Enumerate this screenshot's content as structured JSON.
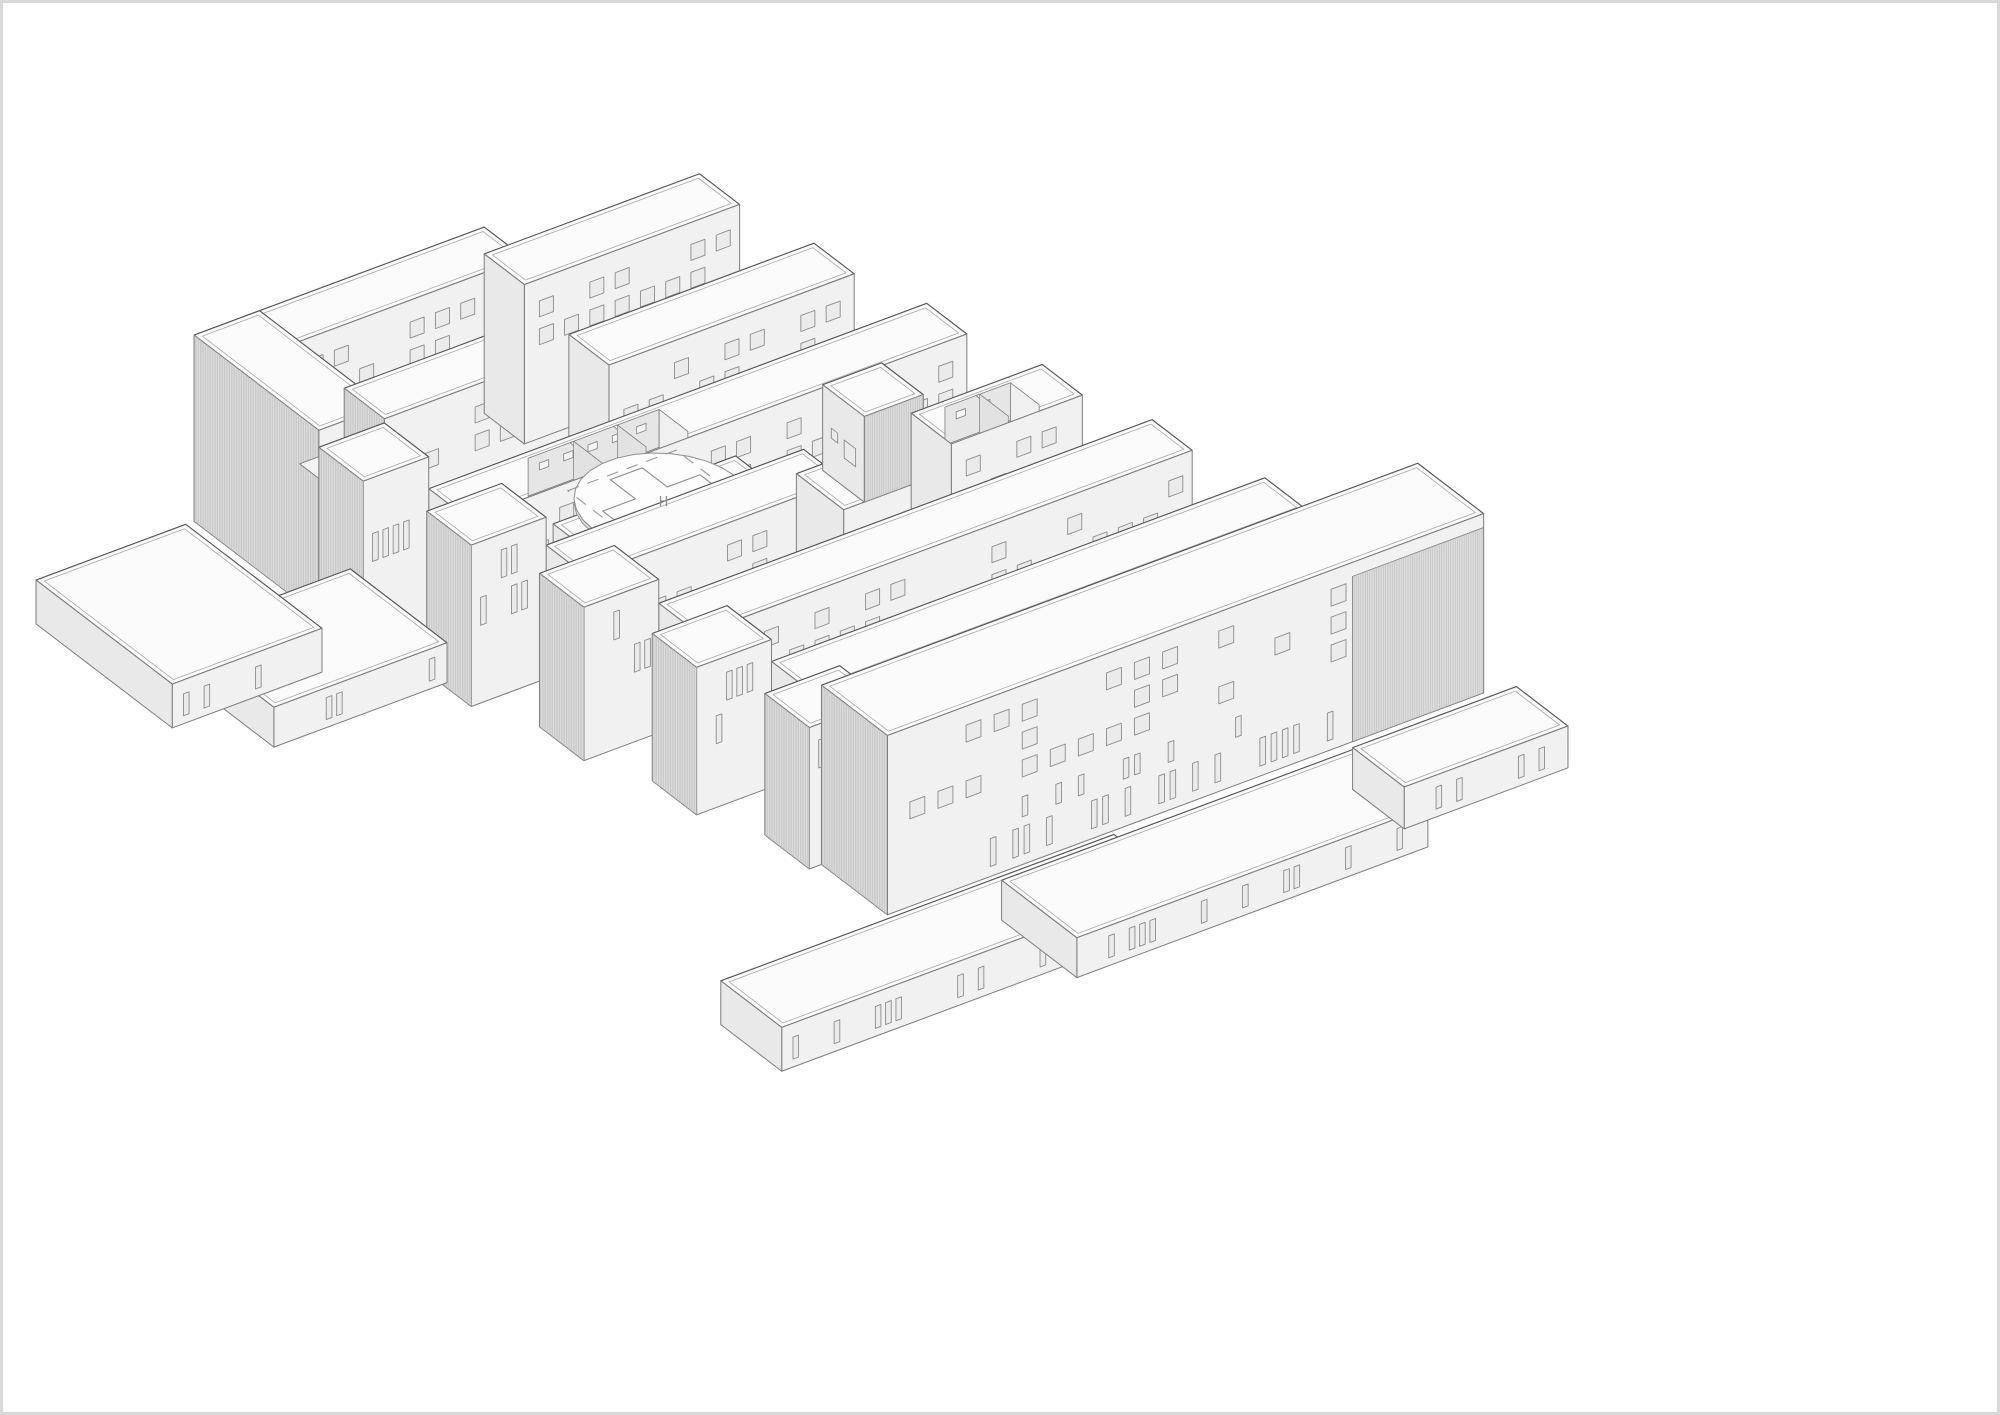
{
  "title": "Axonometric massing drawing of a hospital complex",
  "canvas": {
    "width": 2000,
    "height": 1415,
    "background": "#ffffff",
    "frame_color": "#d9d9d9"
  },
  "palette": {
    "roof": "#fbfbfb",
    "facade": "#f1f1f1",
    "end_face": "#e9e9e9",
    "hatch_bg": "#dcdcdc",
    "hatch_line": "#c3c3c3",
    "courtyard_wall": "#e6e6e6",
    "floor": "#f3f3f3",
    "hole_floor": "#ededed",
    "line": "#7d7d7d",
    "line_dark": "#565656",
    "inset_line": "#a8a8a8",
    "window_line": "#8c8c8c",
    "window_fill": "#ebebeb",
    "pad_top": "#fdfdfd",
    "pad_side": "#dadada",
    "pad_line": "#8f8f8f",
    "dash_line": "#9a9a9a"
  },
  "projection": {
    "ox": 200,
    "oy": 565,
    "u": [
      0.94,
      -0.35
    ],
    "v": [
      0.72,
      0.55
    ]
  },
  "helipad": {
    "a": 245,
    "b": 322,
    "z": 150,
    "radius": 76,
    "square_half": 58,
    "cross_arm": 52,
    "cross_width": 17,
    "dash_pattern": "12 9",
    "label": "H"
  },
  "masses": [
    {
      "name": "block-a-back-wing",
      "a0": 0,
      "a1": 300,
      "b0": 0,
      "b1": 56,
      "z0": 48,
      "z1": 235,
      "win": "sq",
      "seed": 11,
      "roofInset": true
    },
    {
      "name": "block-a-left-block",
      "a0": -10,
      "a1": 60,
      "b0": 0,
      "b1": 174,
      "z0": 48,
      "z1": 235,
      "win": "slit",
      "seed": 12,
      "roofInset": true,
      "hatchLeft": true
    },
    {
      "name": "block-a-courtyard-floor",
      "type": "slab",
      "a0": 60,
      "a1": 300,
      "b0": 56,
      "b1": 118,
      "zTop": 112
    },
    {
      "name": "block-a-front-wing",
      "a0": 60,
      "a1": 300,
      "b0": 118,
      "b1": 174,
      "z0": 48,
      "z1": 222,
      "win": "sq",
      "seed": 13,
      "roofInset": true,
      "hatchLeft": true
    },
    {
      "name": "back-long-bar",
      "a0": 300,
      "a1": 530,
      "b0": 0,
      "b1": 56,
      "z0": 48,
      "z1": 208,
      "win": "sq",
      "seed": 14,
      "roofInset": true
    },
    {
      "name": "row1-bar",
      "a0": 300,
      "a1": 562,
      "b0": 118,
      "b1": 174,
      "z0": 48,
      "z1": 192,
      "win": "sq",
      "seed": 15,
      "roofInset": true
    },
    {
      "name": "row2-bar",
      "a0": 60,
      "a1": 592,
      "b0": 236,
      "b1": 292,
      "z0": 48,
      "z1": 186,
      "win": "sq",
      "seed": 16,
      "roofInset": true,
      "hole": {
        "a0": 160,
        "a1": 300,
        "b0": 244,
        "b1": 284,
        "dividers": 2
      }
    },
    {
      "name": "helipad-pedestal",
      "a0": 150,
      "a1": 345,
      "b0": 292,
      "b1": 354,
      "z0": 48,
      "z1": 150,
      "roofInset": true,
      "helipad": true
    },
    {
      "name": "row3-bar-left",
      "a0": 95,
      "a1": 370,
      "b0": 354,
      "b1": 410,
      "z0": 48,
      "z1": 182,
      "win": "sq",
      "seed": 17,
      "roofInset": true
    },
    {
      "name": "plant-room-pedestal",
      "a0": 370,
      "a1": 485,
      "b0": 344,
      "b1": 410,
      "z0": 48,
      "z1": 152,
      "roofInset": true
    },
    {
      "name": "plant-room-cube",
      "a0": 392,
      "a1": 455,
      "b0": 352,
      "b1": 410,
      "z0": 152,
      "z1": 238,
      "roofInset": true,
      "hatchFacade": "full",
      "cubeWin": true
    },
    {
      "name": "row3-bar-right",
      "a0": 485,
      "a1": 625,
      "b0": 354,
      "b1": 410,
      "z0": 48,
      "z1": 178,
      "win": "sq",
      "seed": 18,
      "roofInset": true,
      "hole": {
        "a0": 515,
        "a1": 585,
        "b0": 362,
        "b1": 402,
        "dividers": 1
      }
    },
    {
      "name": "row4-bar",
      "a0": 125,
      "a1": 652,
      "b0": 472,
      "b1": 528,
      "z0": 48,
      "z1": 178,
      "win": "sq",
      "seed": 19,
      "roofInset": true
    },
    {
      "name": "row5-bar",
      "a0": 155,
      "a1": 682,
      "b0": 590,
      "b1": 646,
      "z0": 48,
      "z1": 174,
      "win": "sq",
      "seed": 20,
      "roofInset": true
    },
    {
      "name": "spine-block-1",
      "a0": -10,
      "a1": 60,
      "b0": 174,
      "b1": 236,
      "z0": 48,
      "z1": 218,
      "win": "slit",
      "seed": 21,
      "roofInset": true,
      "hatchLeft": true
    },
    {
      "name": "spine-block-2",
      "a0": 15,
      "a1": 95,
      "b0": 292,
      "b1": 354,
      "z0": 48,
      "z1": 210,
      "win": "slit",
      "seed": 22,
      "roofInset": true,
      "hatchLeft": true
    },
    {
      "name": "spine-block-3",
      "a0": 45,
      "a1": 125,
      "b0": 410,
      "b1": 472,
      "z0": 48,
      "z1": 202,
      "win": "slit",
      "seed": 23,
      "roofInset": true,
      "hatchLeft": true
    },
    {
      "name": "spine-block-4",
      "a0": 75,
      "a1": 155,
      "b0": 528,
      "b1": 590,
      "z0": 48,
      "z1": 196,
      "win": "slit",
      "seed": 24,
      "roofInset": true,
      "hatchLeft": true
    },
    {
      "name": "spine-block-5",
      "a0": 105,
      "a1": 185,
      "b0": 646,
      "b1": 708,
      "z0": 48,
      "z1": 190,
      "win": "slit",
      "seed": 25,
      "roofInset": true,
      "hatchLeft": true
    },
    {
      "name": "front-main-block",
      "a0": 118,
      "a1": 755,
      "b0": 708,
      "b1": 800,
      "z0": 48,
      "z1": 228,
      "win": "front",
      "seed": 26,
      "roofInset": true,
      "hatchLeft": true,
      "hatchFacade": {
        "a0": 615,
        "a1": 755,
        "z0": 48,
        "z1": 214
      }
    },
    {
      "name": "plinth-terrace-left-upper",
      "a0": -120,
      "a1": 65,
      "b0": 120,
      "b1": 255,
      "z0": 0,
      "z1": 40,
      "win": "slit",
      "seed": 28,
      "roofInset": true
    },
    {
      "name": "plinth-terrace-left",
      "a0": -175,
      "a1": -15,
      "b0": -5,
      "b1": 185,
      "z0": 0,
      "z1": 44,
      "win": "slit",
      "seed": 27,
      "roofInset": true
    },
    {
      "name": "plinth-terrace-bottom",
      "a0": -60,
      "a1": 360,
      "b0": 800,
      "b1": 885,
      "z0": 0,
      "z1": 44,
      "win": "slit",
      "seed": 29,
      "roofInset": true
    },
    {
      "name": "plinth-terrace-bottom-right",
      "a0": 240,
      "a1": 615,
      "b0": 800,
      "b1": 905,
      "z0": 0,
      "z1": 40,
      "win": "slit",
      "seed": 30,
      "roofInset": true
    },
    {
      "name": "terrace-right-annex",
      "a0": 615,
      "a1": 790,
      "b0": 800,
      "b1": 872,
      "z0": 0,
      "z1": 42,
      "win": "slit",
      "seed": 31,
      "roofInset": true
    }
  ]
}
